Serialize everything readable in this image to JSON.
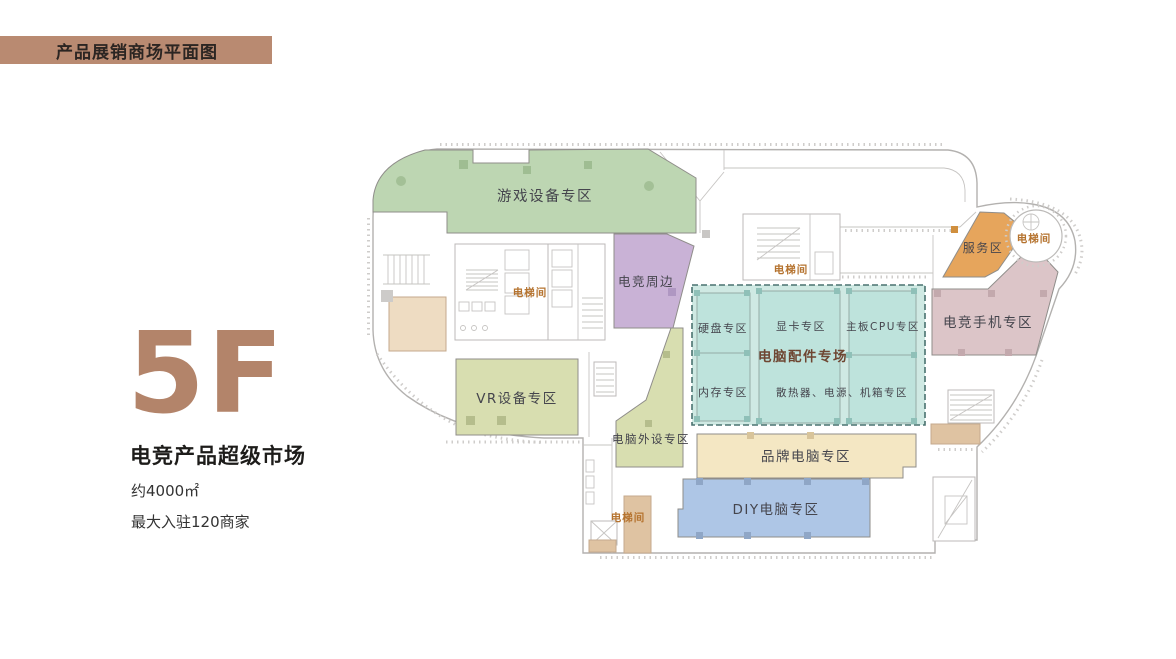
{
  "header": {
    "title": "产品展销商场平面图"
  },
  "info": {
    "floor": "5F",
    "market_name": "电竞产品超级市场",
    "area": "约4000㎡",
    "capacity": "最大入驻120商家"
  },
  "zones": {
    "game_equipment": "游戏设备专区",
    "esports_peripheral": "电竞周边",
    "vr_equipment": "VR设备专区",
    "computer_peripheral": "电脑外设专区",
    "pc_parts_hall": "电脑配件专场",
    "hdd": "硬盘专区",
    "gpu": "显卡专区",
    "mainboard_cpu": "主板CPU专区",
    "ram": "内存专区",
    "cooling_psu_case": "散热器、电源、机箱专区",
    "brand_pc": "品牌电脑专区",
    "diy_pc": "DIY电脑专区",
    "esports_phone": "电竞手机专区",
    "service": "服务区",
    "elevator": "电梯间"
  },
  "colors": {
    "header_bg": "#b98a71",
    "accent": "#b3846a",
    "title_text": "#2b2522",
    "green_zone": "#bdd6b2",
    "purple_zone": "#c9b2d6",
    "olive_zone": "#d8deb0",
    "teal_bg": "#cfe9e3",
    "teal_cell": "#bee3dc",
    "cream_zone": "#f4e7c3",
    "blue_zone": "#aec6e6",
    "pink_zone": "#dcc5c8",
    "orange_zone": "#e6a55c",
    "tan_room": "#dfc3a2",
    "beige_room": "#eedcc2",
    "parts_hall_text": "#6e4632",
    "elevator_text": "#b5732f"
  }
}
